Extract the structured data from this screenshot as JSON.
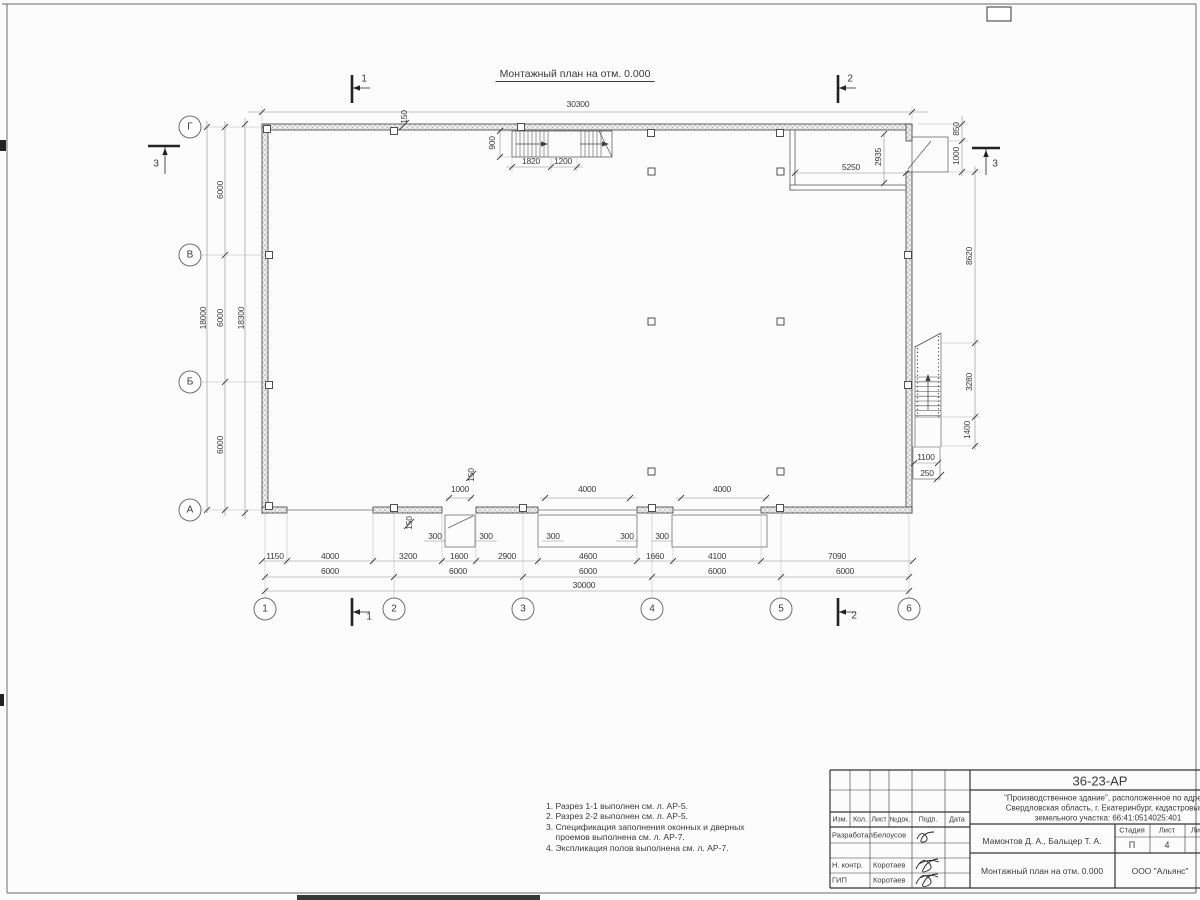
{
  "sheet": {
    "title": "Монтажный план на отм. 0.000"
  },
  "axes": {
    "rows": [
      {
        "label": "Г",
        "x": 190,
        "y": 127
      },
      {
        "label": "В",
        "x": 190,
        "y": 255
      },
      {
        "label": "Б",
        "x": 190,
        "y": 382
      },
      {
        "label": "А",
        "x": 190,
        "y": 510
      }
    ],
    "cols": [
      {
        "label": "1",
        "x": 265,
        "y": 609
      },
      {
        "label": "2",
        "x": 394,
        "y": 609
      },
      {
        "label": "3",
        "x": 523,
        "y": 609
      },
      {
        "label": "4",
        "x": 652,
        "y": 609
      },
      {
        "label": "5",
        "x": 781,
        "y": 609
      },
      {
        "label": "6",
        "x": 909,
        "y": 609
      }
    ]
  },
  "section_labels": [
    {
      "t": "1",
      "x": 364,
      "y": 79
    },
    {
      "t": "2",
      "x": 850,
      "y": 79
    },
    {
      "t": "1",
      "x": 369,
      "y": 617
    },
    {
      "t": "2",
      "x": 854,
      "y": 616
    },
    {
      "t": "3",
      "x": 156,
      "y": 164
    },
    {
      "t": "3",
      "x": 995,
      "y": 164
    }
  ],
  "dimensions": [
    {
      "t": "30300",
      "x": 578,
      "y": 104
    },
    {
      "t": "150",
      "x": 404,
      "y": 117,
      "r": 1
    },
    {
      "t": "900",
      "x": 492,
      "y": 143,
      "r": 1
    },
    {
      "t": "1820",
      "x": 531,
      "y": 161
    },
    {
      "t": "1200",
      "x": 563,
      "y": 161
    },
    {
      "t": "5250",
      "x": 851,
      "y": 167
    },
    {
      "t": "2935",
      "x": 878,
      "y": 157,
      "r": 1
    },
    {
      "t": "850",
      "x": 956,
      "y": 129,
      "r": 1
    },
    {
      "t": "1000",
      "x": 956,
      "y": 156,
      "r": 1
    },
    {
      "t": "8620",
      "x": 969,
      "y": 256,
      "r": 1
    },
    {
      "t": "3280",
      "x": 969,
      "y": 382,
      "r": 1
    },
    {
      "t": "1400",
      "x": 967,
      "y": 430,
      "r": 1
    },
    {
      "t": "1100",
      "x": 926,
      "y": 457
    },
    {
      "t": "250",
      "x": 927,
      "y": 473
    },
    {
      "t": "6000",
      "x": 220,
      "y": 190,
      "r": 1
    },
    {
      "t": "6000",
      "x": 220,
      "y": 318,
      "r": 1
    },
    {
      "t": "6000",
      "x": 220,
      "y": 445,
      "r": 1
    },
    {
      "t": "18000",
      "x": 203,
      "y": 318,
      "r": 1
    },
    {
      "t": "18300",
      "x": 241,
      "y": 318,
      "r": 1
    },
    {
      "t": "1000",
      "x": 460,
      "y": 489
    },
    {
      "t": "150",
      "x": 471,
      "y": 475,
      "r": 1
    },
    {
      "t": "4000",
      "x": 587,
      "y": 489
    },
    {
      "t": "4000",
      "x": 722,
      "y": 489
    },
    {
      "t": "150",
      "x": 409,
      "y": 523,
      "r": 1
    },
    {
      "t": "300",
      "x": 435,
      "y": 536
    },
    {
      "t": "300",
      "x": 486,
      "y": 536
    },
    {
      "t": "300",
      "x": 553,
      "y": 536
    },
    {
      "t": "300",
      "x": 627,
      "y": 536
    },
    {
      "t": "300",
      "x": 662,
      "y": 536
    },
    {
      "t": "1150",
      "x": 275,
      "y": 556
    },
    {
      "t": "4000",
      "x": 330,
      "y": 556
    },
    {
      "t": "3200",
      "x": 408,
      "y": 556
    },
    {
      "t": "1600",
      "x": 459,
      "y": 556
    },
    {
      "t": "2900",
      "x": 507,
      "y": 556
    },
    {
      "t": "4600",
      "x": 588,
      "y": 556
    },
    {
      "t": "1660",
      "x": 655,
      "y": 556
    },
    {
      "t": "4100",
      "x": 717,
      "y": 556
    },
    {
      "t": "7090",
      "x": 837,
      "y": 556
    },
    {
      "t": "6000",
      "x": 330,
      "y": 571
    },
    {
      "t": "6000",
      "x": 458,
      "y": 571
    },
    {
      "t": "6000",
      "x": 588,
      "y": 571
    },
    {
      "t": "6000",
      "x": 717,
      "y": 571
    },
    {
      "t": "6000",
      "x": 845,
      "y": 571
    },
    {
      "t": "30000",
      "x": 584,
      "y": 585
    }
  ],
  "notes": {
    "lines": [
      "1. Разрез 1-1 выполнен см. л. АР-5.",
      "2. Разрез 2-2 выполнен см. л. АР-5.",
      "3. Спецификация заполнения оконных и дверных",
      "    проемов выполнена см. л. АР-7.",
      "4. Экспликация полов выполнена см. л. АР-7."
    ]
  },
  "title_block": {
    "doc_number": "36-23-АР",
    "description_line1": "\"Производственное здание\", расположенное по адресу:",
    "description_line2": "Свердловская область, г. Екатеринбург, кадастровый н",
    "description_line3": "земельного участка: 66:41:0514025:401",
    "col_izm": "Изм.",
    "col_kol": "Кол.",
    "col_list": "Лист",
    "col_ndoc": "№док.",
    "col_podp": "Подп.",
    "col_data": "Дата",
    "role1": "Разработал",
    "name1": "Белоусов",
    "role2": "Н. контр.",
    "name2": "Коротаев",
    "role3": "ГИП",
    "name3": "Коротаев",
    "authors": "Мамонтов Д. А., Бальцер Т. А.",
    "stage_label": "Стадия",
    "sheet_label": "Лист",
    "sheets_label": "Листов",
    "stage": "П",
    "sheet_no": "4",
    "drawing_title": "Монтажный план на отм. 0.000",
    "company": "ООО \"Альянс\""
  }
}
